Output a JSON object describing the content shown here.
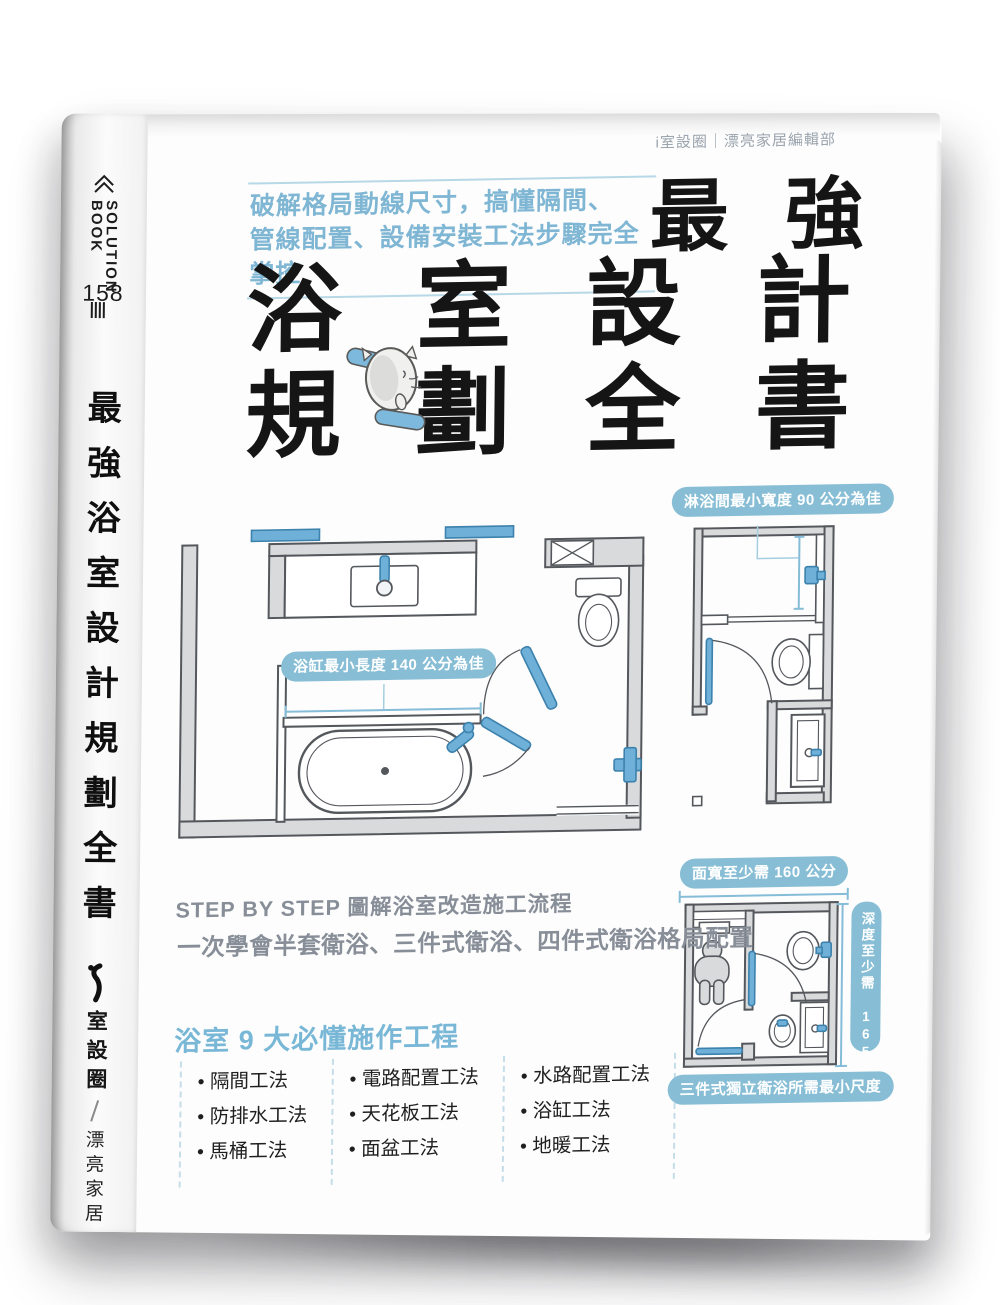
{
  "book": {
    "spine": {
      "series_name_line1": "SOLUTION",
      "series_name_line2": "BOOK",
      "series_number": "158",
      "title": "最強浴室設計規劃全書",
      "publisher_name": "室設圈",
      "publisher_subname": "漂亮家居"
    },
    "cover": {
      "author_credit": "i室設圈｜漂亮家居編輯部",
      "tagline_line1": "破解格局動線尺寸，搞懂隔間、",
      "tagline_line2": "管線配置、設備安裝工法步驟完全掌控",
      "title_emphasis": [
        "最",
        "強"
      ],
      "title_row1": [
        "浴",
        "室",
        "設",
        "計"
      ],
      "title_row2": [
        "規",
        "劃",
        "全",
        "書"
      ],
      "plan_labels": {
        "bathtub_min_length": "浴缸最小長度 140 公分為佳",
        "shower_min_width": "淋浴間最小寬度 90 公分為佳",
        "min_face_width": "面寬至少需 160 公分",
        "min_depth": "深度至少需 165 公分",
        "three_piece_caption": "三件式獨立衛浴所需最小尺度"
      },
      "step_heading": "STEP BY STEP 圖解浴室改造施工流程",
      "step_subheading": "一次學會半套衛浴、三件式衛浴、四件式衛浴格局配置",
      "works_heading": "浴室 9 大必懂施作工程",
      "works_columns": [
        [
          "隔間工法",
          "防排水工法",
          "馬桶工法"
        ],
        [
          "電路配置工法",
          "天花板工法",
          "面盆工法"
        ],
        [
          "水路配置工法",
          "浴缸工法",
          "地暖工法"
        ]
      ]
    },
    "colors": {
      "accent_blue": "#7db8d6",
      "pill_blue": "#87bed5",
      "fixture_blue": "#6fb0d8",
      "dimension_blue": "#85bcd8",
      "wall_gray": "#d8dadc",
      "outline_gray": "#54575c",
      "muted_text_gray": "#8a9199",
      "title_black": "#151515"
    }
  }
}
